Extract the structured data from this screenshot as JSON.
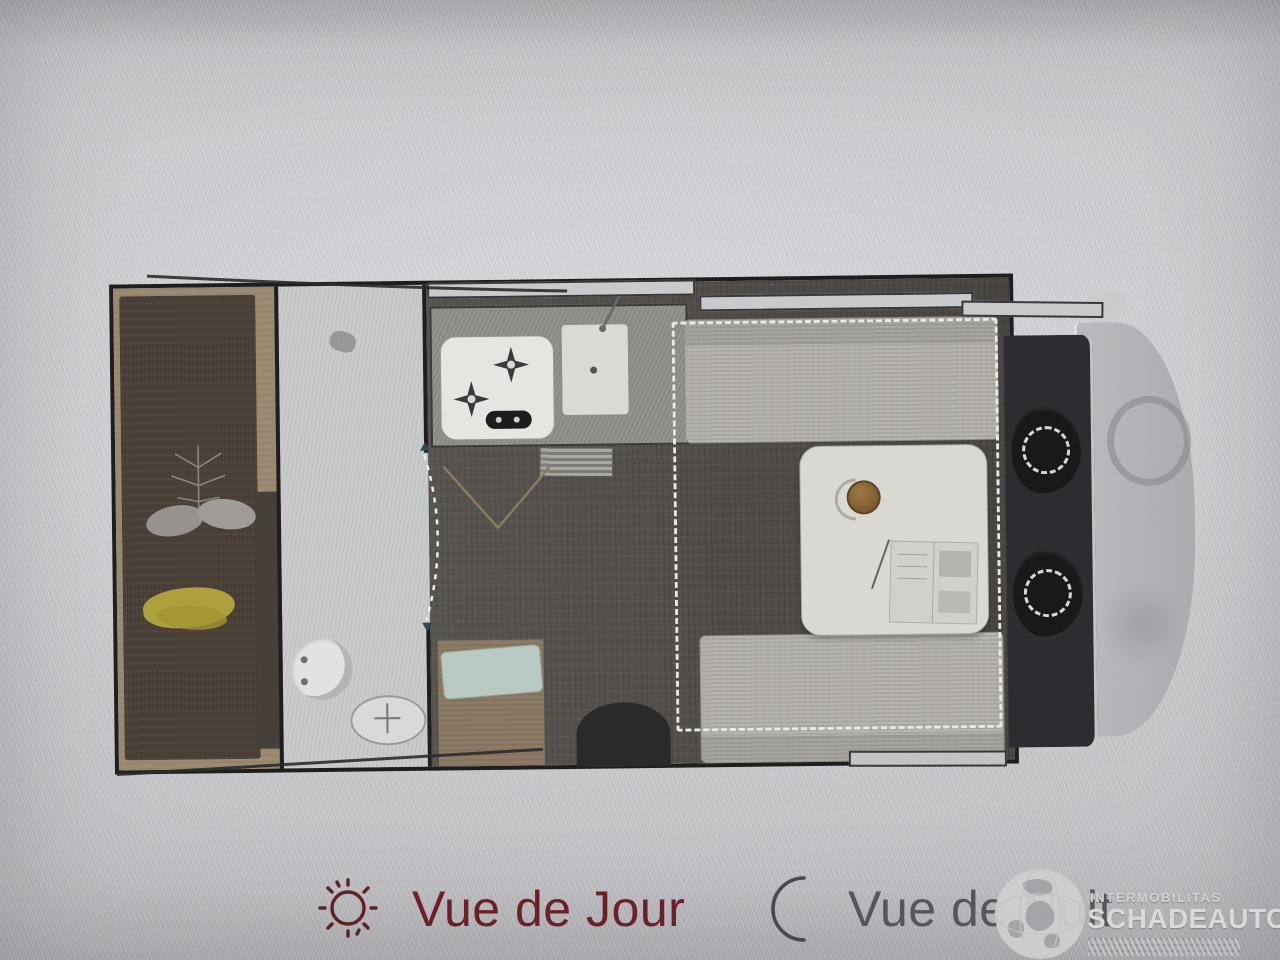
{
  "view_toggle": {
    "day_label": "Vue de Jour",
    "night_label": "Vue de Nuit"
  },
  "watermark": {
    "brand_small": "INTERMOBILITAS",
    "brand_large": "SCHADEAUTOS.NL"
  },
  "icons": {
    "day": "sun-icon",
    "night": "moon-icon",
    "watermark": "globe-icon"
  },
  "colors": {
    "day_accent": "#6b2127",
    "night_accent": "#55555a",
    "wall": "#1e1e1e",
    "floor": "#4f4b47",
    "bed": "#4b4138",
    "bench": "#b4b1ac",
    "table": "#dad8d3",
    "cab": "#2b2d30",
    "cushion_teal": "#b9c8c1",
    "blanket_yellow": "#b5a83e"
  }
}
